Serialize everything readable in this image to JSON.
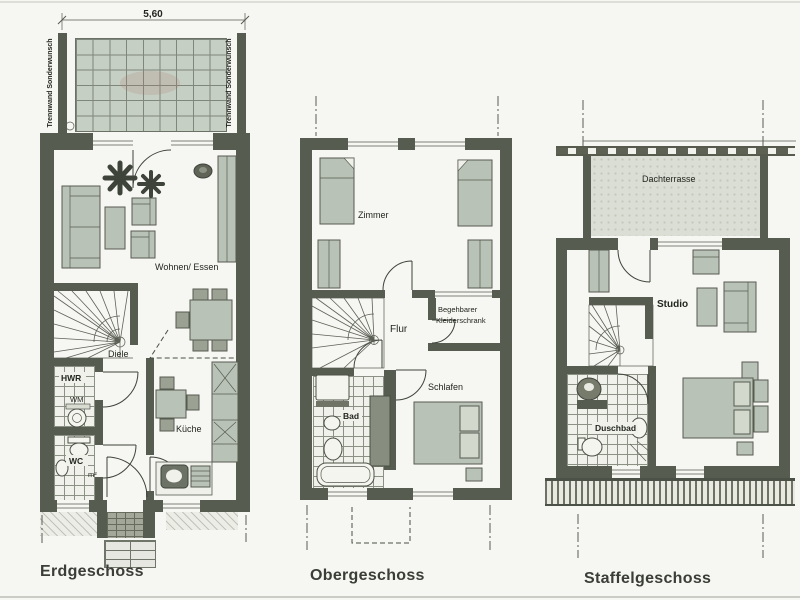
{
  "sheet": {
    "dimension_label": "5,60",
    "partition_left": "Trennwand Sonderwunsch",
    "partition_right": "Trennwand Sonderwunsch"
  },
  "floors": {
    "erdgeschoss": {
      "title": "Erdgeschoss",
      "rooms": {
        "wohnen_essen": "Wohnen/ Essen",
        "diele": "Diele",
        "hwr": "HWR",
        "wm": "WM",
        "wc": "WC",
        "wc_area": "m²",
        "kueche": "Küche"
      }
    },
    "obergeschoss": {
      "title": "Obergeschoss",
      "rooms": {
        "zimmer": "Zimmer",
        "flur": "Flur",
        "kleiderschrank1": "Begehbarer",
        "kleiderschrank2": "Kleiderschrank",
        "schlafen": "Schlafen",
        "bad": "Bad"
      }
    },
    "staffelgeschoss": {
      "title": "Staffelgeschoss",
      "rooms": {
        "dachterrasse": "Dachterrasse",
        "studio": "Studio",
        "duschbad": "Duschbad"
      }
    }
  },
  "colors": {
    "wall": "#575c51",
    "furniture_fill": "#b9c2b6",
    "tile_fill": "#c6cfc4",
    "paper": "#f6f6f2",
    "ink": "#23261f"
  }
}
